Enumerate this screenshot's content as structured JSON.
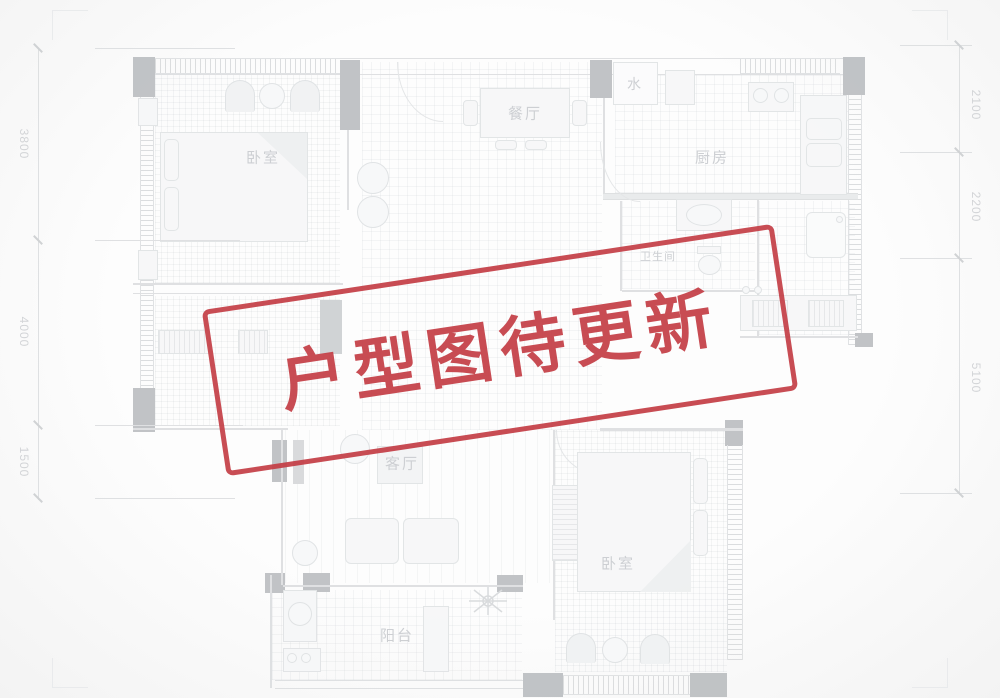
{
  "stamp": {
    "text": "户型图待更新",
    "color": "#c43f47"
  },
  "dimensions": {
    "left": [
      {
        "label": "3800"
      },
      {
        "label": "4000"
      },
      {
        "label": "1500"
      }
    ],
    "right": [
      {
        "label": "2100"
      },
      {
        "label": "2200"
      },
      {
        "label": "5100"
      }
    ]
  },
  "rooms": {
    "bedroom_top_left": "卧室",
    "dining": "餐厅",
    "water": "水",
    "kitchen": "厨房",
    "bathroom": "卫生间",
    "living": "客厅",
    "balcony": "阳台",
    "bedroom_bottom": "卧室"
  }
}
